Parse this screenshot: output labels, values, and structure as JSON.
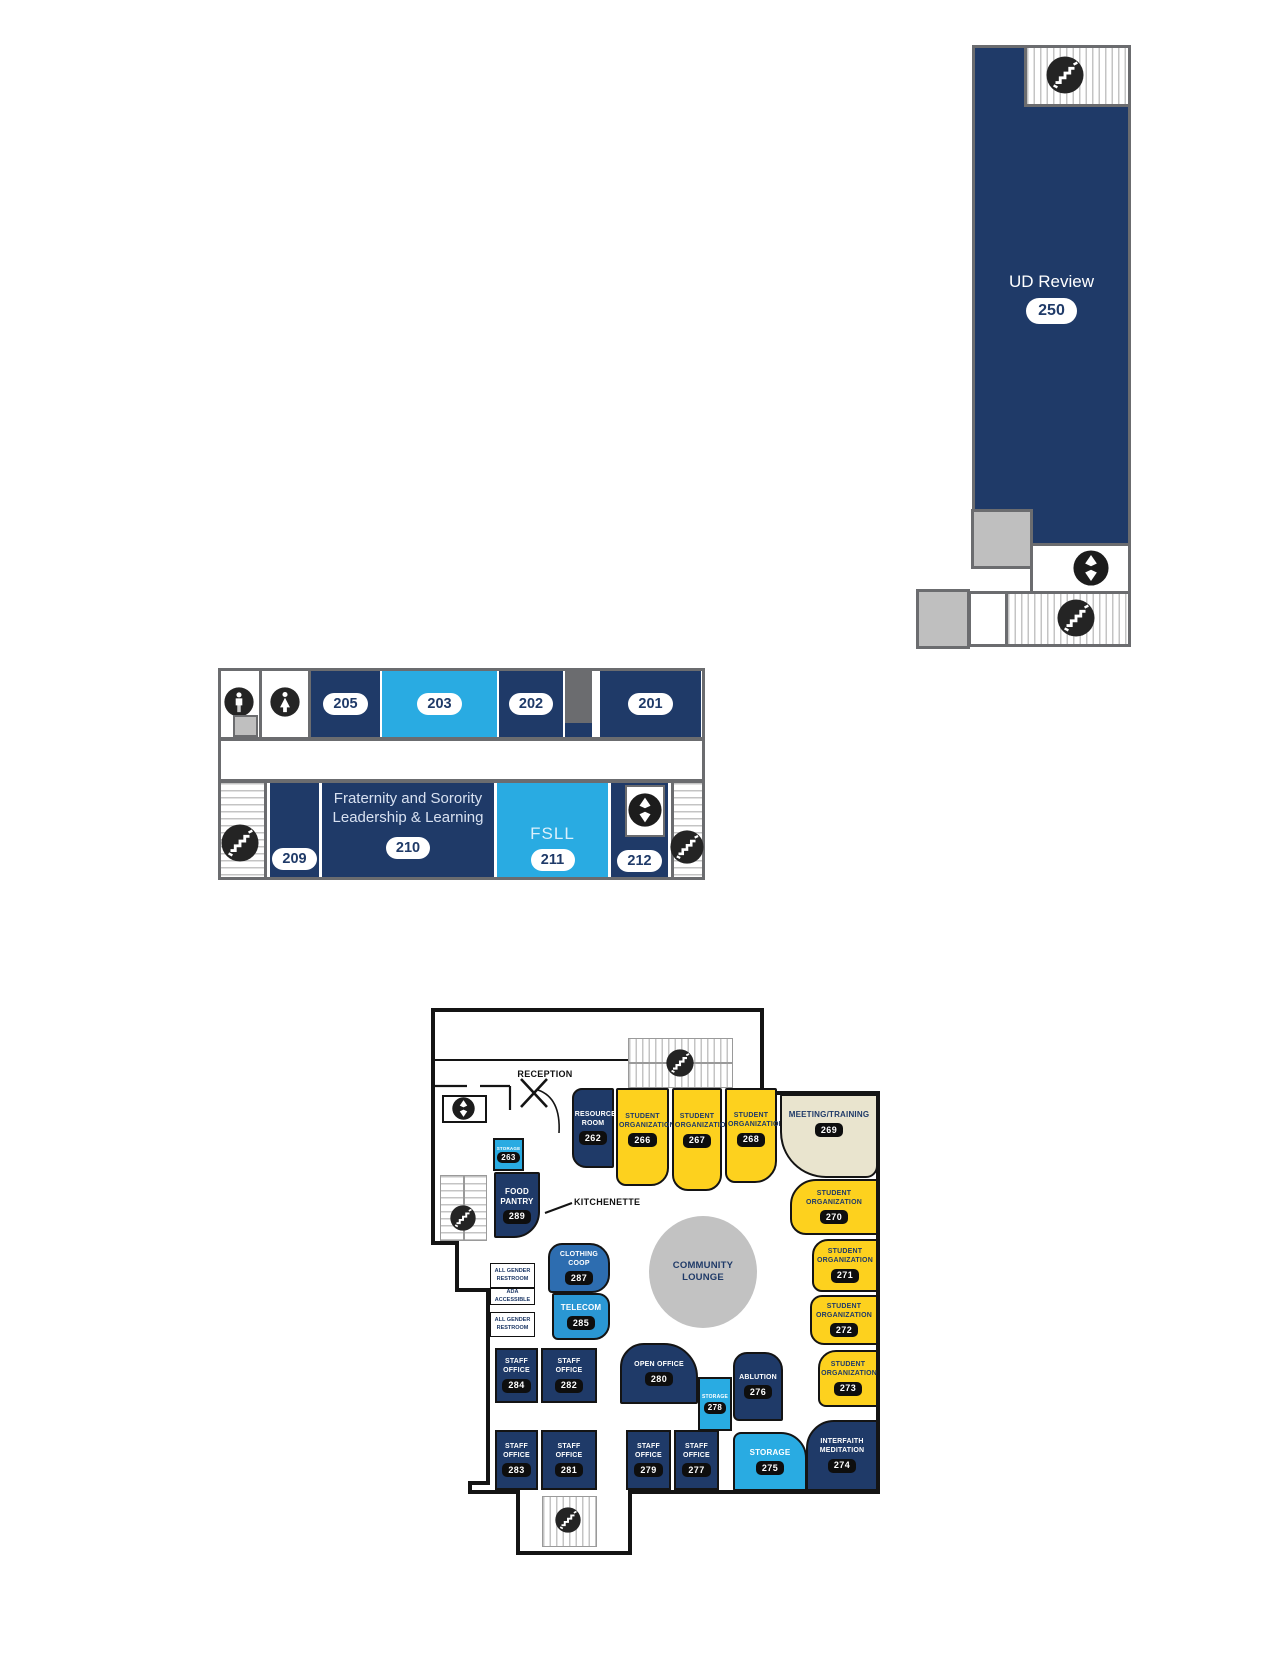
{
  "colors": {
    "navy": "#1f3a68",
    "light_blue": "#29abe2",
    "mid_blue": "#2d6db0",
    "sky_blue": "#2a97d4",
    "yellow": "#fdd11e",
    "beige": "#e9e4ce",
    "gray_fill": "#bfbfbf",
    "lounge_gray": "#c2c2c2",
    "wall_gray": "#6b6c6f",
    "wall_black": "#141414",
    "badge_dark_bg": "#0e0e0e",
    "badge_light_bg": "#ffffff"
  },
  "icons": {
    "stairs": "stairs-icon",
    "elevator": "elevator-icon",
    "mens_restroom": "mens-restroom-icon",
    "womens_restroom": "womens-restroom-icon"
  },
  "upper": {
    "name": "UD Review",
    "number": "250"
  },
  "middle": {
    "top_rooms": [
      {
        "number": "205"
      },
      {
        "number": "203"
      },
      {
        "number": "202"
      },
      {
        "number": "201"
      }
    ],
    "bottom_rooms": [
      {
        "number": "209"
      },
      {
        "name": "Fraternity and Sorority Leadership & Learning",
        "number": "210"
      },
      {
        "name": "FSLL",
        "number": "211"
      },
      {
        "number": "212"
      }
    ]
  },
  "lower": {
    "reception": "RECEPTION",
    "kitchenette": "KITCHENETTE",
    "community_lounge": "COMMUNITY LOUNGE",
    "restroom_top": "ALL GENDER RESTROOM",
    "ada": "ADA ACCESSIBLE",
    "restroom_bottom": "ALL GENDER RESTROOM",
    "rooms": [
      {
        "name": "RESOURCE ROOM",
        "number": "262"
      },
      {
        "name": "STUDENT ORGANIZATION",
        "number": "266"
      },
      {
        "name": "STUDENT ORGANIZATION",
        "number": "267"
      },
      {
        "name": "STUDENT ORGANIZATION",
        "number": "268"
      },
      {
        "name": "MEETING/TRAINING",
        "number": "269"
      },
      {
        "name": "STUDENT ORGANIZATION",
        "number": "270"
      },
      {
        "name": "STUDENT ORGANIZATION",
        "number": "271"
      },
      {
        "name": "STUDENT ORGANIZATION",
        "number": "272"
      },
      {
        "name": "STUDENT ORGANIZATION",
        "number": "273"
      },
      {
        "name": "INTERFAITH MEDITATION",
        "number": "274"
      },
      {
        "name": "STORAGE",
        "number": "275"
      },
      {
        "name": "ABLUTION",
        "number": "276"
      },
      {
        "name": "STAFF OFFICE",
        "number": "277"
      },
      {
        "name": "STORAGE",
        "number": "278"
      },
      {
        "name": "STAFF OFFICE",
        "number": "279"
      },
      {
        "name": "OPEN OFFICE",
        "number": "280"
      },
      {
        "name": "STAFF OFFICE",
        "number": "281"
      },
      {
        "name": "STAFF OFFICE",
        "number": "282"
      },
      {
        "name": "STAFF OFFICE",
        "number": "283"
      },
      {
        "name": "STAFF OFFICE",
        "number": "284"
      },
      {
        "name": "TELECOM",
        "number": "285"
      },
      {
        "name": "CLOTHING COOP",
        "number": "287"
      },
      {
        "name": "FOOD PANTRY",
        "number": "289"
      },
      {
        "name": "STORAGE",
        "number": "263"
      }
    ]
  }
}
